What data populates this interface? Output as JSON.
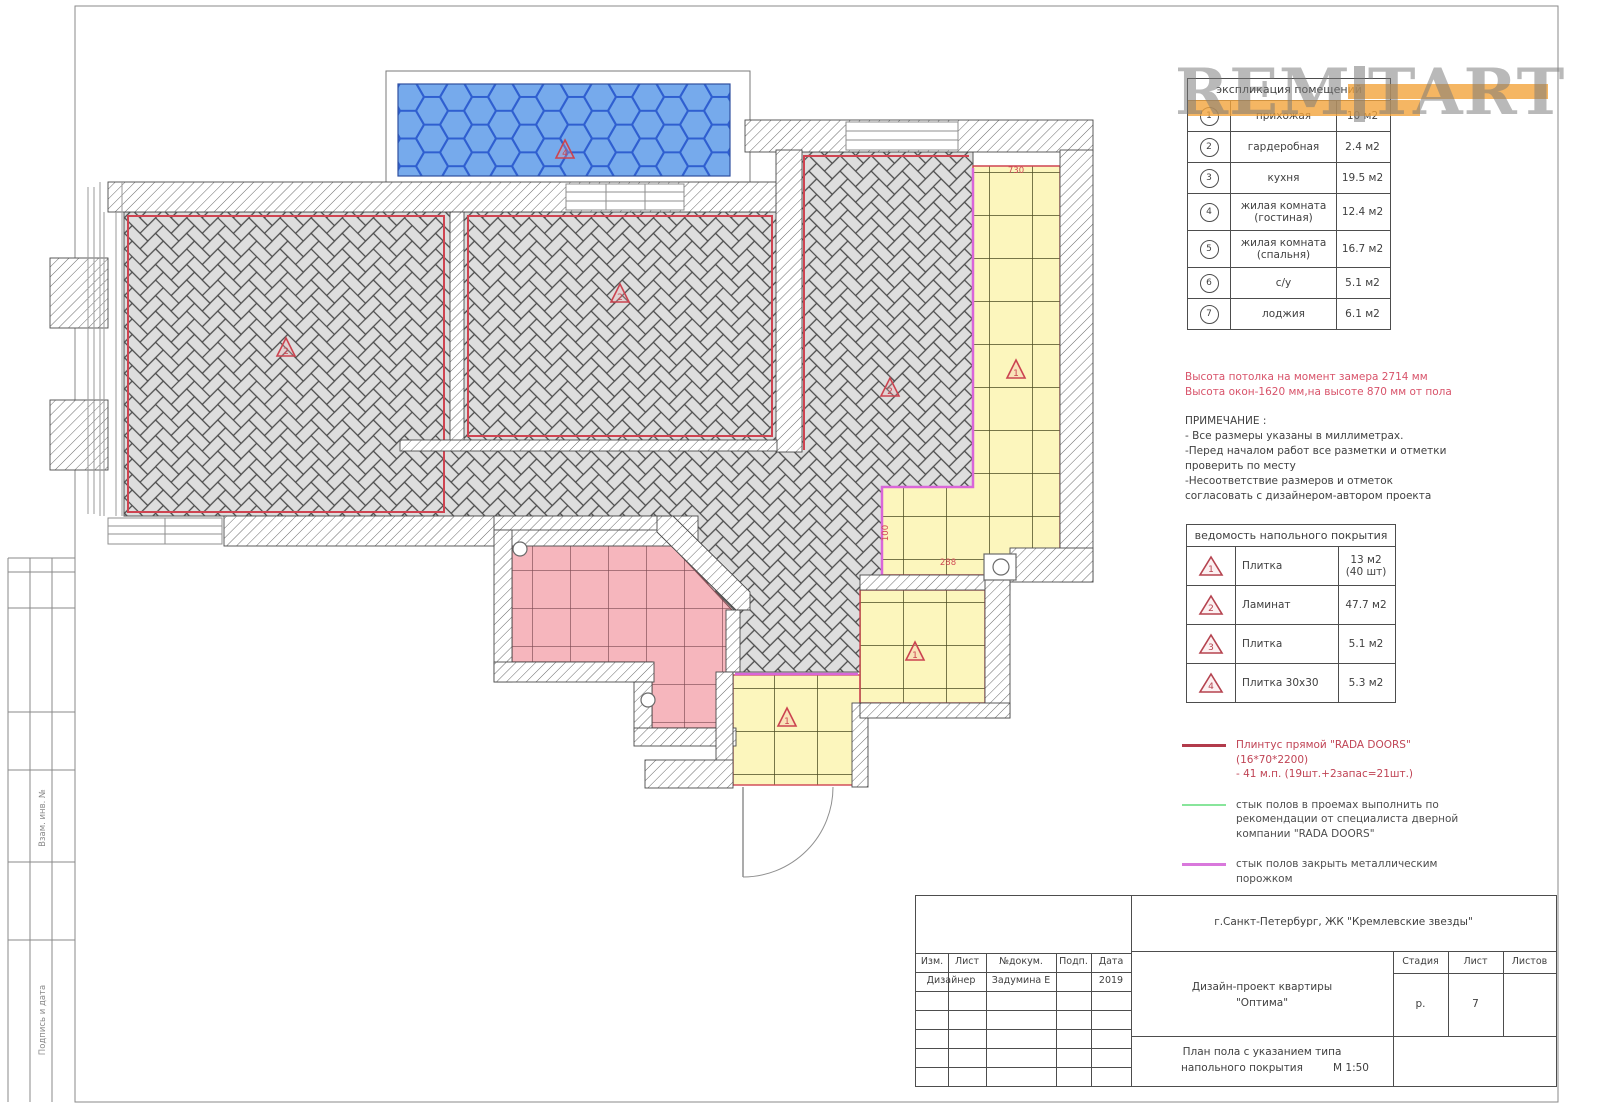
{
  "watermark": {
    "text_left": "REM",
    "text_right": "TART",
    "accent_color": "#f3a43c"
  },
  "explication": {
    "title": "экспликация помещений",
    "rows": [
      {
        "num": "1",
        "name": "прихожая",
        "area": "10 м2"
      },
      {
        "num": "2",
        "name": "гардеробная",
        "area": "2.4 м2"
      },
      {
        "num": "3",
        "name": "кухня",
        "area": "19.5 м2"
      },
      {
        "num": "4",
        "name": "жилая комната (гостиная)",
        "area": "12.4 м2"
      },
      {
        "num": "5",
        "name": "жилая комната (спальня)",
        "area": "16.7 м2"
      },
      {
        "num": "6",
        "name": "с/у",
        "area": "5.1 м2"
      },
      {
        "num": "7",
        "name": "лоджия",
        "area": "6.1 м2"
      }
    ]
  },
  "notes": {
    "red_lines": [
      "Высота потолка на момент замера 2714 мм",
      "Высота окон-1620 мм,на высоте 870 мм от пола"
    ],
    "title": "ПРИМЕЧАНИЕ :",
    "items": [
      "- Все размеры указаны в миллиметрах.",
      "-Перед началом работ все разметки и отметки проверить по месту",
      "-Несоответствие размеров и отметок согласовать с дизайнером-автором проекта"
    ]
  },
  "flooring": {
    "title": "ведомость напольного покрытия",
    "rows": [
      {
        "num": "1",
        "name": "Плитка",
        "area": "13 м2 (40 шт)"
      },
      {
        "num": "2",
        "name": "Ламинат",
        "area": "47.7 м2"
      },
      {
        "num": "3",
        "name": "Плитка",
        "area": "5.1 м2"
      },
      {
        "num": "4",
        "name": "Плитка 30х30",
        "area": "5.3 м2"
      }
    ]
  },
  "legend": [
    {
      "line_color": "#b23b4b",
      "text_color": "#c04455",
      "text": "Плинтус прямой \"RADA DOORS\" (16*70*2200)\n-  41 м.п. (19шт.+2запас=21шт.)"
    },
    {
      "line_color": "#88e59b",
      "text_color": "#4d4d4d",
      "text": "стык полов в проемах выполнить по\nрекомендации от специалиста дверной\nкомпании \"RADA DOORS\""
    },
    {
      "line_color": "#d978dc",
      "text_color": "#4d4d4d",
      "text": "стык полов закрыть металлическим\nпорожком"
    }
  ],
  "title_block": {
    "address": "г.Санкт-Петербург, ЖК \"Кремлевские звезды\"",
    "cols": [
      "Изм.",
      "Лист",
      "№докум.",
      "Подп.",
      "Дата"
    ],
    "row_role": "Дизайнер",
    "row_name": "Задумина Е",
    "row_date": "2019",
    "project_line1": "Дизайн-проект квартиры",
    "project_line2": "\"Оптима\"",
    "stage_label": "Стадия",
    "sheet_label": "Лист",
    "sheets_label": "Листов",
    "stage_value": "р.",
    "sheet_value": "7",
    "sheets_value": "",
    "sheet_name_line1": "План пола с указанием типа",
    "sheet_name_line2": "напольного покрытия",
    "scale": "М 1:50"
  },
  "frame": {
    "left_labels": [
      "Взам. инв. №",
      "Подпись и дата"
    ]
  },
  "plan": {
    "markers": [
      {
        "n": "4",
        "x": 565,
        "y": 150
      },
      {
        "n": "2",
        "x": 286,
        "y": 348
      },
      {
        "n": "2",
        "x": 620,
        "y": 294
      },
      {
        "n": "2",
        "x": 890,
        "y": 388
      },
      {
        "n": "1",
        "x": 1016,
        "y": 370
      },
      {
        "n": "1",
        "x": 915,
        "y": 652
      },
      {
        "n": "1",
        "x": 787,
        "y": 718
      }
    ],
    "dimensions": [
      {
        "t": "730",
        "x": 1016,
        "y": 173,
        "r": 0
      },
      {
        "t": "100",
        "x": 888,
        "y": 533,
        "r": -90
      },
      {
        "t": "288",
        "x": 948,
        "y": 565,
        "r": 0
      }
    ]
  }
}
